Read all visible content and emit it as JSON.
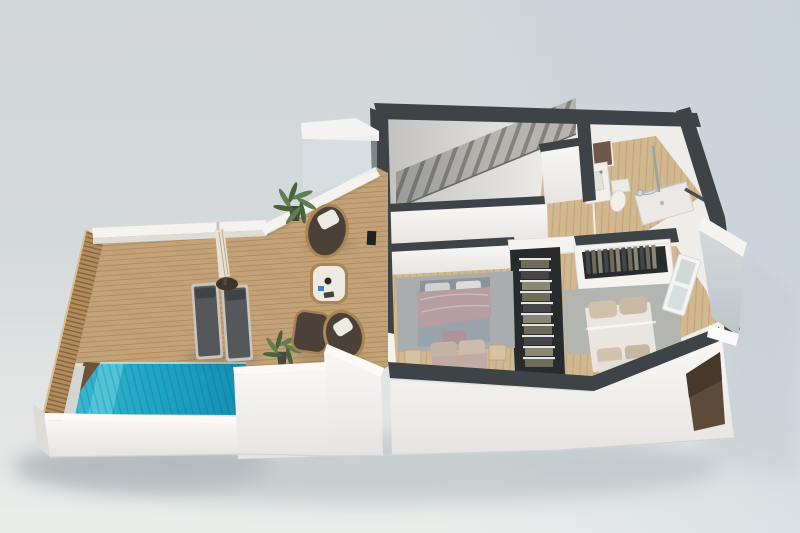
{
  "scene": {
    "title": "3D cutaway floor plan render — upper level with pool terrace, lounge terrace, staircase hall, bathroom and two bedrooms",
    "style": "photorealistic dollhouse top-down perspective render",
    "areas": [
      {
        "name": "pool-terrace",
        "objects": [
          "swimming-pool",
          "wood-deck",
          "slatted-wood-fence",
          "two-sun-loungers",
          "closed-parasol",
          "grey-outdoor-panel"
        ]
      },
      {
        "name": "lounge-terrace",
        "objects": [
          "wicker-armchair",
          "wicker-armchair",
          "wicker-ottoman",
          "coffee-table",
          "potted-palm",
          "potted-palm",
          "glass-balustrade"
        ]
      },
      {
        "name": "staircase-hall",
        "objects": [
          "concrete-stairs",
          "half-wall",
          "landing-wall"
        ]
      },
      {
        "name": "bathroom",
        "objects": [
          "vanity-sink",
          "toilet",
          "walk-in-shower",
          "shower-column",
          "wall-niche",
          "towel-rail"
        ]
      },
      {
        "name": "bedroom-1",
        "objects": [
          "double-bed",
          "area-rug",
          "nightstand",
          "nightstand",
          "foot-bench",
          "open-wardrobe-with-clothes"
        ]
      },
      {
        "name": "bedroom-2",
        "objects": [
          "double-bed",
          "area-rug",
          "open-wardrobe-with-clothes",
          "window",
          "foot-bench"
        ]
      }
    ]
  },
  "colors": {
    "bg_top": "#d1d6d9",
    "bg_bottom": "#eaecea",
    "ground_shadow": "#9aa7ae",
    "wall_white": "#f4f3f0",
    "wall_bright": "#fbfaf8",
    "wall_shade": "#dedcd7",
    "wall_grey": "#c7cdd1",
    "wall_dark": "#3e4347",
    "wall_dark_deep": "#2c2f32",
    "deck_wood": "#c4a277",
    "floor_wood": "#d2b88f",
    "wood_dark": "#6e5136",
    "pool_light": "#3cb9cf",
    "pool_mid": "#21a7c6",
    "pool_deep": "#148fb4",
    "pool_steps": "#5ecbdd",
    "stair_tread": "#b5b4af",
    "stair_riser": "#83827c",
    "rug": "#aaadae",
    "rug2": "#b3b5b0",
    "bed1_head": "#8e9397",
    "bed1_duvet": "#9aa3ab",
    "bed1_throw": "#b69da1",
    "bed1_pillow": "#d9dbdd",
    "bed2_duvet": "#eae6df",
    "bed2_pillow": "#c9b8a4",
    "bench_beige": "#c7b5a7",
    "nightstand": "#d5c2a2",
    "closet_dark": "#282b2d",
    "clothes_a": "#6e6b58",
    "clothes_b": "#44464a",
    "clothes_c": "#8a8774",
    "hanger": "#e6e6e2",
    "cushion": "#4b4138",
    "wicker": "#ab8457",
    "pillow_white": "#edeae2",
    "lounger": "#54585b",
    "lounger_frame": "#c9c6bf",
    "lounger_dark": "#3f4346",
    "parasol": "#e8e1d1",
    "parasol_base": "#40342b",
    "plant": "#5f7f4f",
    "plant_dark": "#46633b",
    "pot": "#4a463f",
    "fixture": "#f0efeb",
    "chrome": "#9aa2a7",
    "niche_brown": "#6f5847",
    "recess_brown": "#5d4a38",
    "glass": "#dce8ee",
    "window_pane": "#cfdad6"
  }
}
